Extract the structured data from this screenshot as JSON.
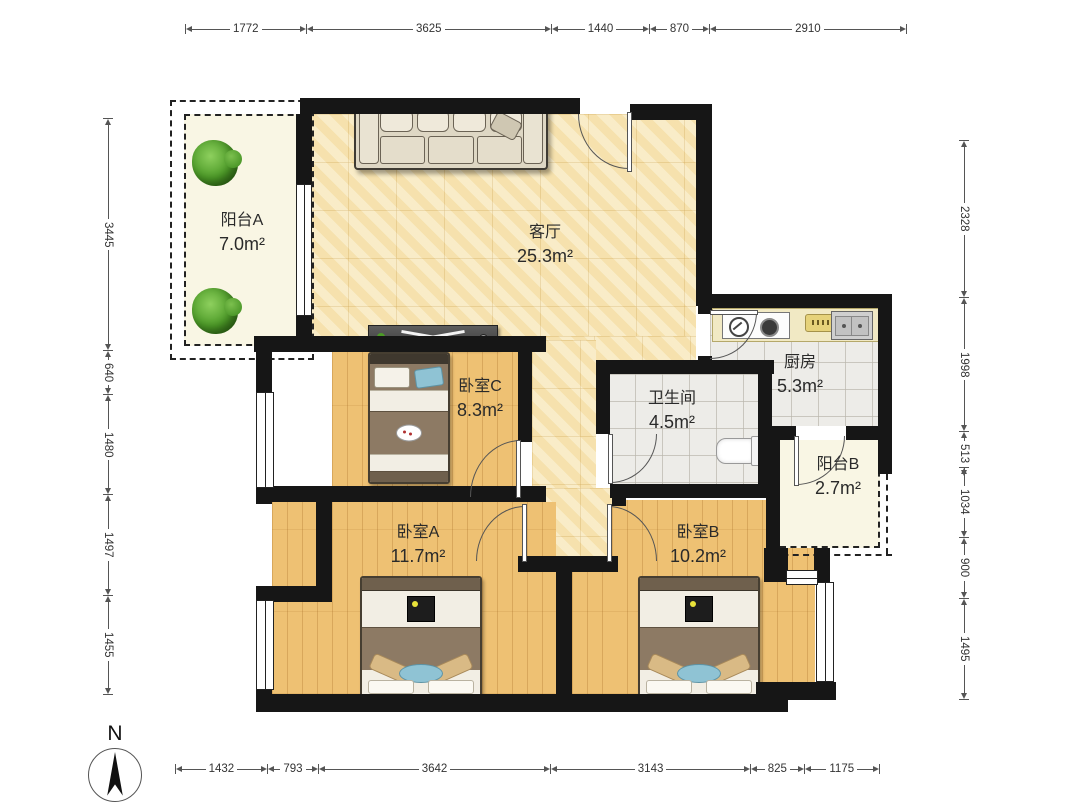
{
  "floorplan": {
    "compass_label": "N",
    "rooms": {
      "balcony_a": {
        "name": "阳台A",
        "area": "7.0m²"
      },
      "living_room": {
        "name": "客厅",
        "area": "25.3m²"
      },
      "kitchen": {
        "name": "厨房",
        "area": "5.3m²"
      },
      "bathroom": {
        "name": "卫生间",
        "area": "4.5m²"
      },
      "bedroom_c": {
        "name": "卧室C",
        "area": "8.3m²"
      },
      "balcony_b": {
        "name": "阳台B",
        "area": "2.7m²"
      },
      "bedroom_a": {
        "name": "卧室A",
        "area": "11.7m²"
      },
      "bedroom_b": {
        "name": "卧室B",
        "area": "10.2m²"
      }
    },
    "dimensions": {
      "top": [
        "1772",
        "3625",
        "1440",
        "870",
        "2910"
      ],
      "bottom": [
        "1432",
        "793",
        "3642",
        "3143",
        "825",
        "1175"
      ],
      "left": [
        "3445",
        "640",
        "1480",
        "1497",
        "1455"
      ],
      "right": [
        "2328",
        "1998",
        "513",
        "1034",
        "900",
        "1495"
      ]
    },
    "colors": {
      "wall": "#161616",
      "living_floor": "#f8e9bd",
      "wood_floor": "#eec173",
      "tile_floor": "#edece8",
      "balcony_floor": "#f9f6e4",
      "plant_green": "#4c9a27",
      "dimension_line": "#555555"
    }
  }
}
